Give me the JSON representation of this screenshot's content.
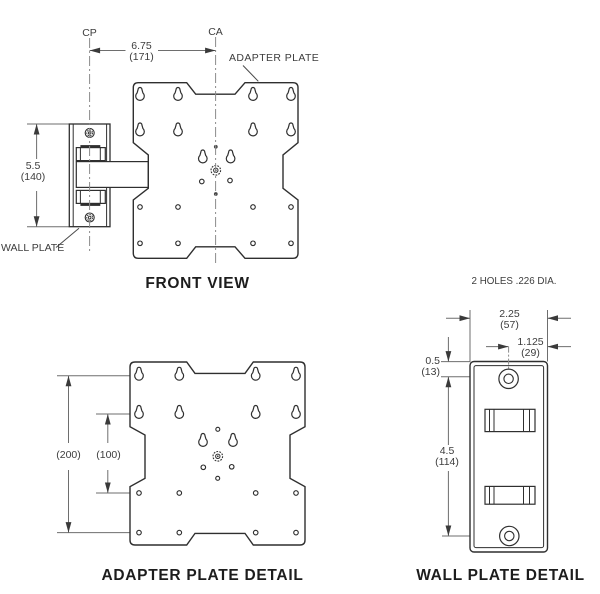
{
  "palette": {
    "background": "#ffffff",
    "object_line": "#2f2f2f",
    "dimension_line": "#6e6e6e",
    "centerline": "#8a8a8a",
    "text": "#3d3d3d"
  },
  "front_view": {
    "caption": "FRONT VIEW",
    "cp_label": "CP",
    "ca_label": "CA",
    "adapter_plate_label": "ADAPTER PLATE",
    "wall_plate_label": "WALL PLATE",
    "dim_width_in": "6.75",
    "dim_width_mm": "(171)",
    "dim_height_in": "5.5",
    "dim_height_mm": "(140)"
  },
  "adapter_plate_detail": {
    "caption": "ADAPTER PLATE DETAIL",
    "dim_outer_mm": "(200)",
    "dim_inner_mm": "(100)"
  },
  "wall_plate_detail": {
    "caption": "WALL PLATE DETAIL",
    "holes_note": "2 HOLES .226 DIA.",
    "dim_width_in": "2.25",
    "dim_width_mm": "(57)",
    "dim_half_in": "1.125",
    "dim_half_mm": "(29)",
    "dim_top_in": "0.5",
    "dim_top_mm": "(13)",
    "dim_span_in": "4.5",
    "dim_span_mm": "(114)"
  }
}
